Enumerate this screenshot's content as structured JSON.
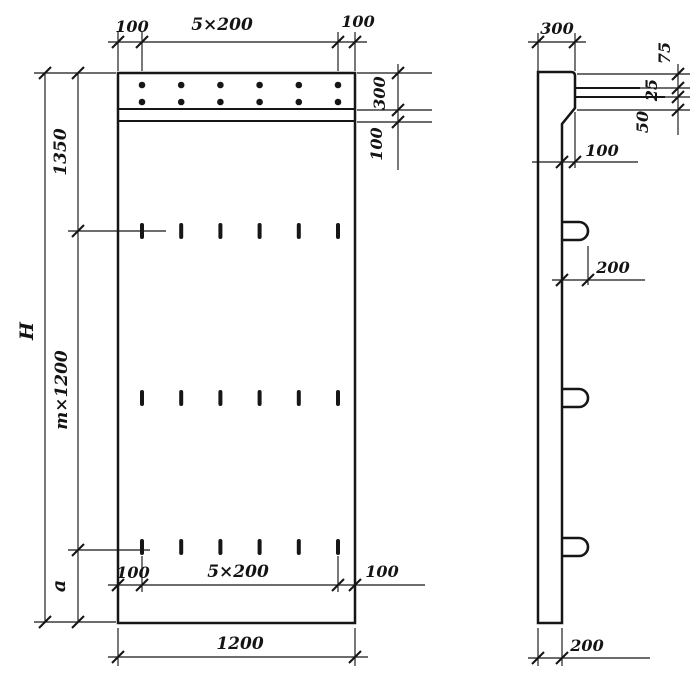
{
  "front_view": {
    "dimensions": {
      "top_left": "100",
      "top_span": "5×200",
      "top_right": "100",
      "right_band": "300",
      "right_strip": "100",
      "height_overall": "H",
      "top_segment": "1350",
      "middle_segment": "m×1200",
      "bottom_segment": "a",
      "bottom_left": "100",
      "bottom_span": "5×200",
      "bottom_right": "100",
      "width_overall": "1200"
    },
    "features": {
      "bolt_rows": 2,
      "bolt_cols": 6,
      "slot_rows": 3,
      "slot_cols": 6
    }
  },
  "side_view": {
    "dimensions": {
      "top_width": "300",
      "detail_top": "75",
      "detail_mid": "25",
      "detail_bottom": "50",
      "ledge_offset": "100",
      "loop_protrusion": "200",
      "bottom_width": "200"
    },
    "features": {
      "loops": 3
    }
  },
  "colors": {
    "ink": "#161616",
    "paper": "#ffffff"
  }
}
